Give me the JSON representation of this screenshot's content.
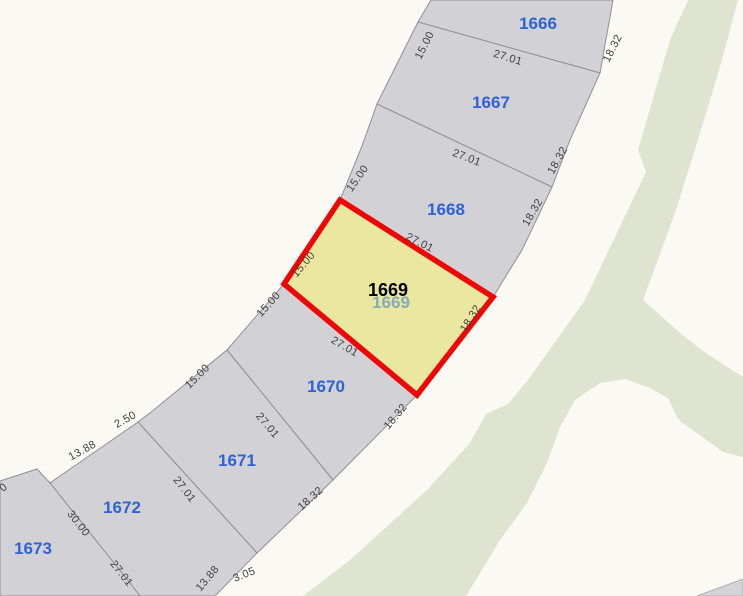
{
  "map": {
    "canvas": {
      "width": 743,
      "height": 596
    },
    "colors": {
      "road_background": "#faf9f3",
      "greenspace": "#dee4cf",
      "parcel_fill": "#d2d2d6",
      "parcel_stroke": "#8f8f95",
      "highlight_fill": "#eae7a1",
      "highlight_stroke": "#ee0707",
      "parcel_label": "#2f62d4",
      "selected_label": "#000000",
      "ghost_label": "#86abb9",
      "dim_text": "#3f3f3f",
      "corner_fill": "#d4d4d8",
      "corner_stroke": "#b0b0b5"
    },
    "greenspace_area": {
      "points": "688,0 738,0 720,67 700,133 675,213 643,300 660,315 680,333 703,351 727,367 743,377 743,457 723,452 690,428 681,422 677,417 668,398 650,388 625,379 600,383 575,400 560,427 547,463 527,503 500,540 466,596 303,596 350,560 427,490 470,443 486,414 508,404 528,380 585,300 646,172 638,150 670,40"
    },
    "corner_parcel": {
      "points": "697,596 743,579 743,596"
    },
    "parcels": [
      {
        "label": "1666",
        "points": "431,0 613,0 600,73 418,22",
        "label_x": 538,
        "label_y": 29,
        "selected": false
      },
      {
        "label": "1667",
        "points": "418,22 600,73 570,140 552,187 377,104",
        "label_x": 491,
        "label_y": 108,
        "selected": false
      },
      {
        "label": "1668",
        "points": "377,104 552,187 522,250 493,297 340,200 362,146",
        "label_x": 446,
        "label_y": 215,
        "selected": false
      },
      {
        "label": "1669",
        "points": "340,200 493,297 417,395 284,284",
        "label_x": 388,
        "label_y": 296,
        "selected": true
      },
      {
        "label": "1670",
        "points": "284,284 417,395 333,480 227,350",
        "label_x": 326,
        "label_y": 392,
        "selected": false
      },
      {
        "label": "1671",
        "points": "227,350 333,480 257,553 138,422 150,413",
        "label_x": 237,
        "label_y": 466,
        "selected": false
      },
      {
        "label": "1672",
        "points": "138,422 257,553 215,596 140,596 130,583 50,483",
        "label_x": 122,
        "label_y": 513,
        "selected": false
      },
      {
        "label": "1673",
        "points": "0,481 37,469 50,483 130,583 140,596 0,596",
        "label_x": 33,
        "label_y": 554,
        "selected": false
      }
    ],
    "selected_overlay": {
      "label": "1669",
      "label_x": 388,
      "label_y": 296,
      "ghost_label": "1669",
      "ghost_x": 391,
      "ghost_y": 308
    },
    "dimension_labels": [
      {
        "text": "15.00",
        "x": 424,
        "y": 45,
        "rot": -63
      },
      {
        "text": "27.01",
        "x": 508,
        "y": 57,
        "rot": 17
      },
      {
        "text": "18.32",
        "x": 612,
        "y": 48,
        "rot": -63
      },
      {
        "text": "27.01",
        "x": 467,
        "y": 157,
        "rot": 21
      },
      {
        "text": "18.32",
        "x": 557,
        "y": 160,
        "rot": -61
      },
      {
        "text": "15.00",
        "x": 357,
        "y": 178,
        "rot": -55
      },
      {
        "text": "27.01",
        "x": 420,
        "y": 242,
        "rot": 27
      },
      {
        "text": "18.32",
        "x": 532,
        "y": 212,
        "rot": -60
      },
      {
        "text": "15.00",
        "x": 303,
        "y": 264,
        "rot": -50
      },
      {
        "text": "18.32",
        "x": 470,
        "y": 318,
        "rot": -58
      },
      {
        "text": "27.01",
        "x": 345,
        "y": 346,
        "rot": 30
      },
      {
        "text": "15.00",
        "x": 268,
        "y": 304,
        "rot": -48
      },
      {
        "text": "27.01",
        "x": 268,
        "y": 425,
        "rot": 50
      },
      {
        "text": "18.32",
        "x": 395,
        "y": 416,
        "rot": -50
      },
      {
        "text": "15.00",
        "x": 197,
        "y": 376,
        "rot": -45
      },
      {
        "text": "27.01",
        "x": 185,
        "y": 489,
        "rot": 52
      },
      {
        "text": "18.32",
        "x": 310,
        "y": 498,
        "rot": -42
      },
      {
        "text": "2.50",
        "x": 125,
        "y": 419,
        "rot": -29
      },
      {
        "text": "13.88",
        "x": 82,
        "y": 450,
        "rot": -29
      },
      {
        "text": "30.00",
        "x": 79,
        "y": 523,
        "rot": 52
      },
      {
        "text": "27.01",
        "x": 122,
        "y": 573,
        "rot": 52
      },
      {
        "text": "13.88",
        "x": 207,
        "y": 578,
        "rot": -50
      },
      {
        "text": "3.05",
        "x": 244,
        "y": 574,
        "rot": -22
      },
      {
        "text": "0",
        "x": 3,
        "y": 487,
        "rot": -40
      }
    ]
  }
}
